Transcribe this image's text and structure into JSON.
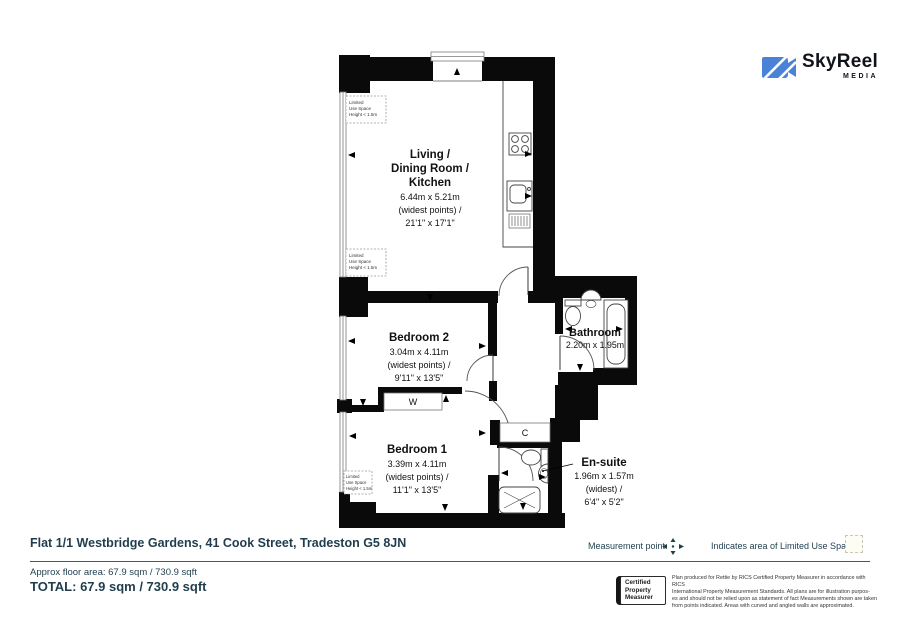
{
  "logo": {
    "name": "SkyReel",
    "sub": "MEDIA"
  },
  "plan": {
    "living": {
      "name_lines": [
        "Living /",
        "Dining Room /",
        "Kitchen"
      ],
      "dims": [
        "6.44m x 5.21m",
        "(widest points) /",
        "21'1\" x 17'1\""
      ]
    },
    "bedroom2": {
      "name": "Bedroom 2",
      "dims": [
        "3.04m x 4.11m",
        "(widest points) /",
        "9'11\" x 13'5\""
      ]
    },
    "bathroom": {
      "name": "Bathroom",
      "dims": [
        "2.20m x 1.95m"
      ]
    },
    "bedroom1": {
      "name": "Bedroom 1",
      "dims": [
        "3.39m x 4.11m",
        "(widest points) /",
        "11'1\" x 13'5\""
      ]
    },
    "ensuite": {
      "name": "En-suite",
      "dims": [
        "1.96m x 1.57m",
        "(widest) /",
        "6'4\" x 5'2\""
      ]
    },
    "wardrobe": "W",
    "cupboard": "C",
    "limited_use": [
      "Limited",
      "Use Space",
      "Height < 1.5m"
    ]
  },
  "footer": {
    "address": "Flat 1/1 Westbridge Gardens, 41 Cook Street, Tradeston G5 8JN",
    "legend": {
      "measurement_point": "Measurement point",
      "limited_use": "Indicates area of  Limited Use Space"
    },
    "approx_area": "Approx floor area: 67.9 sqm / 730.9 sqft",
    "total": "TOTAL: 67.9 sqm / 730.9 sqft",
    "rics": {
      "abbr": "RICS",
      "label": [
        "Certified",
        "Property",
        "Measurer"
      ]
    },
    "disclaimer": [
      "Plan produced for Rettie by RICS Certified Property Measurer in accordance with RICS",
      "International Property  Measurement Standards.  All plans are for illustration purpos-",
      "es and should not be relied upon as statement of fact Measurements shown are taken",
      "from points indicated. Areas with curved and angled walls are approximated."
    ]
  },
  "colors": {
    "heading": "#1f3d4d",
    "wall": "#000000",
    "logo_blue": "#4a82d8"
  }
}
